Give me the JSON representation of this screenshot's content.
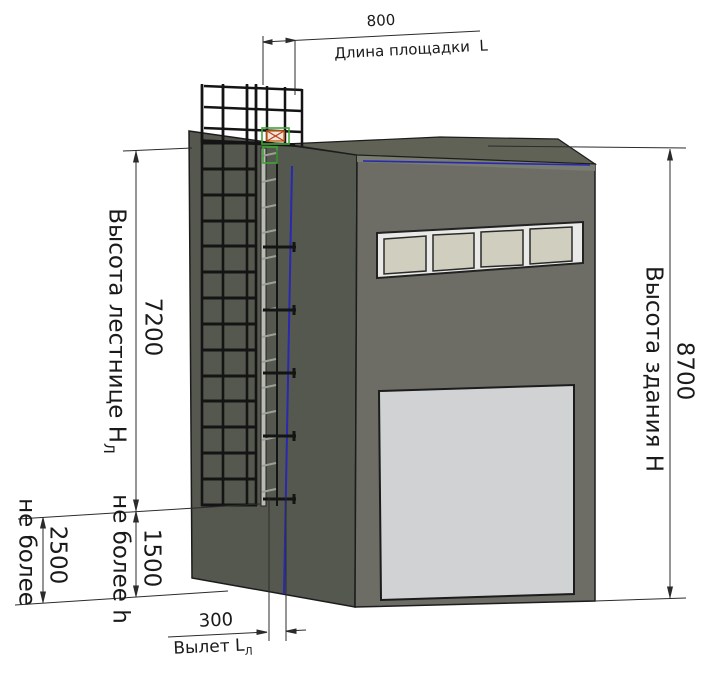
{
  "drawing": {
    "dims": {
      "platform_length": {
        "value": "800",
        "label": "Длина площадки  L"
      },
      "ladder_height": {
        "label": "Высота лестнице Н",
        "sub": "Л",
        "value": "7200"
      },
      "building_height": {
        "label": "Высота здания Н",
        "value": "8700"
      },
      "ground_clearance": {
        "label": "не более",
        "value": "2500"
      },
      "rung_clearance": {
        "label": "не более h",
        "value": "1500"
      },
      "standoff": {
        "value": "300",
        "label": "Вылет L",
        "sub": "Л"
      }
    },
    "colors": {
      "left_wall": "#55584e",
      "right_wall": "#6d6d66",
      "roof": "#5f6255",
      "parapet": "#797c70",
      "door": "#d1d2d4",
      "window_frame": "#e9e9e7",
      "window_pane": "#d0cebf",
      "accent_blue": "#2828b0",
      "accent_green": "#3fa437",
      "accent_orange": "#c96a25",
      "line": "#2b2b2b"
    }
  }
}
